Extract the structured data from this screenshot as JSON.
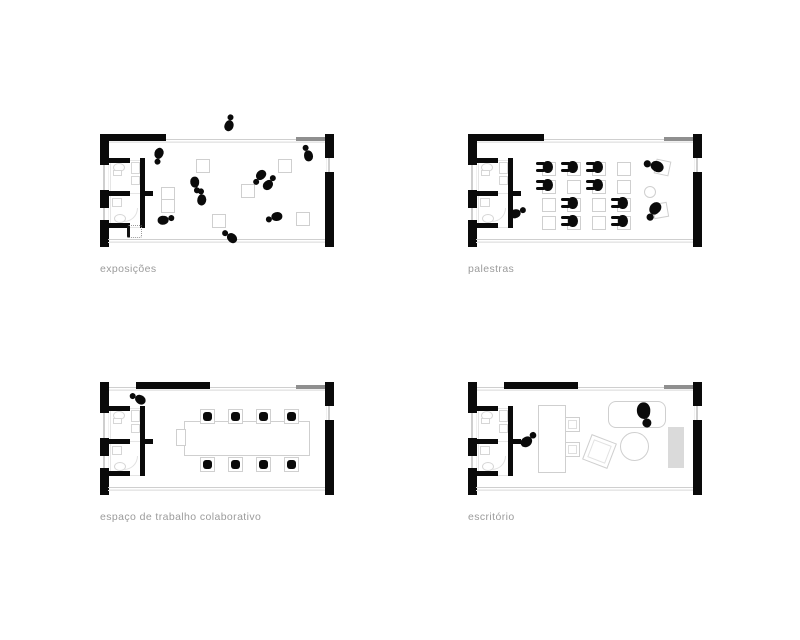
{
  "plans": [
    {
      "id": "exposicoes",
      "label": "exposições"
    },
    {
      "id": "palestras",
      "label": "palestras"
    },
    {
      "id": "espaco-trabalho",
      "label": "espaço de trabalho colaborativo"
    },
    {
      "id": "escritorio",
      "label": "escritório"
    }
  ],
  "colors": {
    "wall": "#0a0a0a",
    "glass_line": "#cfcfcf",
    "furniture_outline": "#cfcfcf",
    "label_text": "#9b9b9b",
    "rug": "#dadada",
    "background": "#ffffff"
  }
}
